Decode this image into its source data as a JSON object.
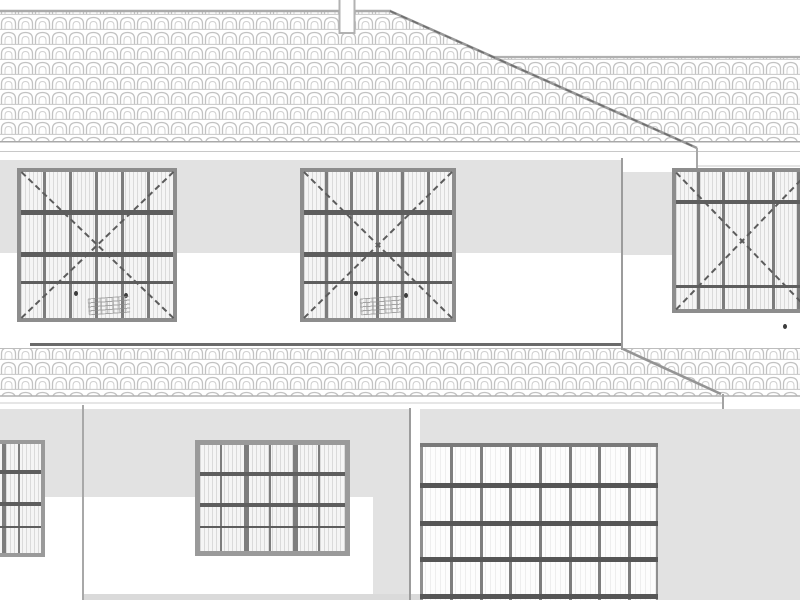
{
  "drawing": {
    "type": "architectural-elevation",
    "subject": "house front elevation with tiled hip roof, upper-floor casement windows, lower roof band, ground-floor windows and sectional garage door"
  },
  "colors": {
    "wall": "#e2e2e2",
    "tile_line": "#c2c2c2",
    "ridge": "#aaaaaa",
    "hip": "#8f8f8f",
    "lower_ridge": "#6a6a6a",
    "frame": "#8d8d8d",
    "mullion": "#7d7d7d",
    "bar": "#5e5e5e",
    "garage_frame": "#7a7a7a",
    "garage_grid": "#7e7e7e",
    "garage_bar": "#565656",
    "ground_strip": "#dadada"
  },
  "roof": {
    "main_ridge": {
      "x1": 0,
      "y": 11,
      "x2": 390
    },
    "hip": {
      "x1": 390,
      "y1": 11,
      "x2": 697,
      "y2": 148
    },
    "wing_ridge": {
      "x1": 493,
      "y": 57,
      "x2": 800
    },
    "eave_y": 141,
    "chimney": {
      "x": 339,
      "w": 15,
      "h": 33
    }
  },
  "lower_roof": {
    "band_top": 348,
    "band_bottom": 396,
    "ridge": {
      "x1": 30,
      "x2": 623,
      "y": 344
    },
    "hip": {
      "x1": 623,
      "y1": 349,
      "x2": 721,
      "y2": 394
    }
  },
  "windows": [
    {
      "name": "upper-window-left",
      "left": 17,
      "top": 168,
      "width": 160,
      "height": 154,
      "frame": 4,
      "paneClass": "pane-hatch",
      "diag": true,
      "vlines": [
        {
          "x": 22,
          "w": 3
        },
        {
          "x": 48,
          "w": 3
        },
        {
          "x": 74,
          "w": 3
        },
        {
          "x": 100,
          "w": 3
        },
        {
          "x": 126,
          "w": 3
        }
      ],
      "hlines": [
        {
          "y": 38,
          "h": 5
        },
        {
          "y": 80,
          "h": 5
        },
        {
          "y": 109,
          "h": 3
        }
      ]
    },
    {
      "name": "upper-window-middle",
      "left": 300,
      "top": 168,
      "width": 156,
      "height": 154,
      "frame": 4,
      "paneClass": "pane-hatch",
      "diag": true,
      "vlines": [
        {
          "x": 21,
          "w": 3
        },
        {
          "x": 46,
          "w": 3
        },
        {
          "x": 72,
          "w": 3
        },
        {
          "x": 97,
          "w": 3
        },
        {
          "x": 123,
          "w": 3
        }
      ],
      "hlines": [
        {
          "y": 38,
          "h": 5
        },
        {
          "y": 80,
          "h": 5
        },
        {
          "y": 109,
          "h": 3
        }
      ]
    },
    {
      "name": "upper-window-right",
      "left": 672,
      "top": 168,
      "width": 140,
      "height": 145,
      "frame": 4,
      "paneClass": "pane-hatch",
      "diag": true,
      "vlines": [
        {
          "x": 21,
          "w": 3
        },
        {
          "x": 46,
          "w": 3
        },
        {
          "x": 71,
          "w": 3
        },
        {
          "x": 96,
          "w": 3
        },
        {
          "x": 121,
          "w": 3
        }
      ],
      "hlines": [
        {
          "y": 28,
          "h": 4
        },
        {
          "y": 113,
          "h": 3
        }
      ]
    },
    {
      "name": "ground-window-left-partial",
      "left": -62,
      "top": 440,
      "width": 107,
      "height": 117,
      "frame": 4,
      "frameColor": "#9a9a9a",
      "paneClass": "pane-hatch",
      "diag": false,
      "vlines": [
        {
          "x": 14,
          "w": 2
        },
        {
          "x": 29,
          "w": 4
        },
        {
          "x": 45,
          "w": 2
        },
        {
          "x": 60,
          "w": 4
        },
        {
          "x": 76,
          "w": 2
        }
      ],
      "hlines": [
        {
          "y": 26,
          "h": 4
        },
        {
          "y": 58,
          "h": 4
        },
        {
          "y": 82,
          "h": 2
        }
      ]
    },
    {
      "name": "ground-window-middle",
      "left": 195,
      "top": 440,
      "width": 155,
      "height": 116,
      "frame": 5,
      "frameColor": "#9a9a9a",
      "paneClass": "pane-hatch",
      "diag": false,
      "vlines": [
        {
          "x": 20,
          "w": 2
        },
        {
          "x": 44,
          "w": 5
        },
        {
          "x": 69,
          "w": 2
        },
        {
          "x": 93,
          "w": 5
        },
        {
          "x": 118,
          "w": 2
        }
      ],
      "hlines": [
        {
          "y": 27,
          "h": 4
        },
        {
          "y": 58,
          "h": 4
        },
        {
          "y": 81,
          "h": 2
        }
      ]
    },
    {
      "name": "garage-door",
      "left": 420,
      "top": 443,
      "width": 238,
      "height": 157,
      "frame": 0,
      "paneClass": "pane-light",
      "diag": false,
      "vlines": [
        {
          "x": 0,
          "w": 2.5,
          "c": "#8f8f8f"
        },
        {
          "x": 30,
          "w": 2.5,
          "c": "#7e7e7e"
        },
        {
          "x": 60,
          "w": 2.5,
          "c": "#7e7e7e"
        },
        {
          "x": 89,
          "w": 2.5,
          "c": "#7e7e7e"
        },
        {
          "x": 119,
          "w": 2.5,
          "c": "#7e7e7e"
        },
        {
          "x": 149,
          "w": 2.5,
          "c": "#7e7e7e"
        },
        {
          "x": 178,
          "w": 2.5,
          "c": "#7e7e7e"
        },
        {
          "x": 208,
          "w": 2.5,
          "c": "#7e7e7e"
        },
        {
          "x": 235.5,
          "w": 2.5,
          "c": "#8f8f8f"
        }
      ],
      "hlines": [
        {
          "y": 0,
          "h": 4,
          "c": "#7a7a7a"
        },
        {
          "y": 40,
          "h": 4.5,
          "c": "#565656"
        },
        {
          "y": 78,
          "h": 4.5,
          "c": "#565656"
        },
        {
          "y": 114,
          "h": 4.5,
          "c": "#565656"
        },
        {
          "y": 151,
          "h": 4.5,
          "c": "#565656"
        }
      ]
    }
  ],
  "annotations": {
    "dots": [
      {
        "x": 74,
        "y": 291
      },
      {
        "x": 124,
        "y": 293
      },
      {
        "x": 354,
        "y": 291
      },
      {
        "x": 404,
        "y": 293
      },
      {
        "x": 783,
        "y": 324
      }
    ],
    "smudges": [
      {
        "x": 88,
        "y": 297,
        "w": 42,
        "h": 17
      },
      {
        "x": 360,
        "y": 297,
        "w": 42,
        "h": 17
      }
    ]
  }
}
